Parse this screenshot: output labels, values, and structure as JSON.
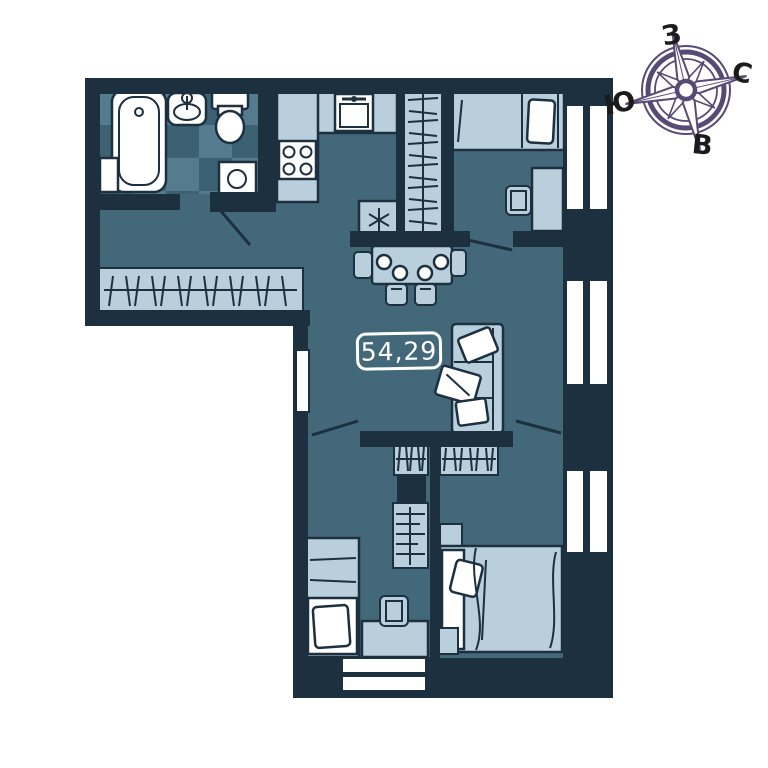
{
  "area_badge": {
    "value": "54,29"
  },
  "compass": {
    "top": "З",
    "right": "С",
    "left": "Ю",
    "bottom": "В"
  },
  "colors": {
    "background": "#ffffff",
    "wall": "#1c3040",
    "floor": "#42687a",
    "furniture_light": "#b9cfdc",
    "fixture_white": "#ffffff",
    "tile_light": "#557b8e",
    "tile_dark": "#3b6173",
    "outline": "#1c3040",
    "compass": "#564b74",
    "compass_text": "#1b1b1b",
    "badge_text": "#ffffff"
  },
  "furniture_icons": [
    "bathtub",
    "bath-cabinet",
    "sink",
    "toilet",
    "washing-machine",
    "kitchen-counter",
    "kitchen-sink",
    "stove",
    "fridge",
    "wardrobe-top",
    "hallway-wardrobe",
    "dining-table",
    "dining-chair",
    "plate",
    "sofa",
    "pillow",
    "blanket",
    "single-bed",
    "desk",
    "chair",
    "double-bed",
    "nightstand",
    "closet",
    "bookshelf",
    "window",
    "door-swing",
    "radiator"
  ]
}
